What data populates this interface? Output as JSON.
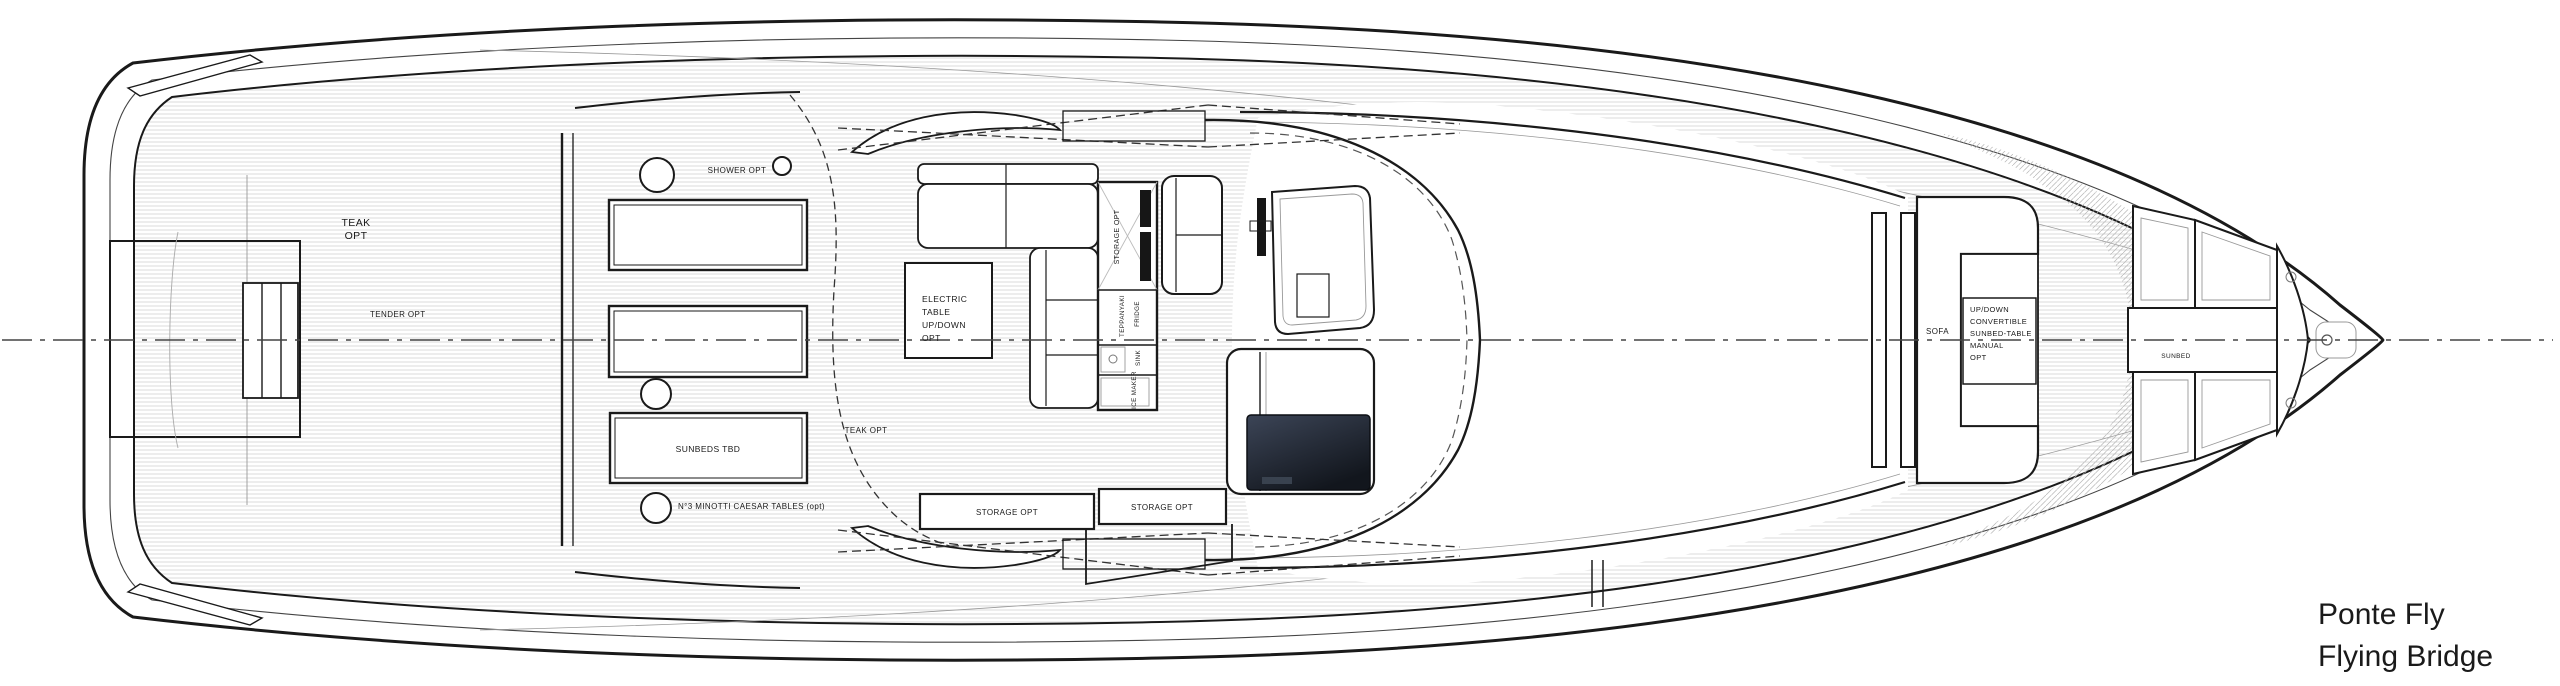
{
  "drawing": {
    "title_line1": "Ponte Fly",
    "title_line2": "Flying Bridge"
  },
  "labels": {
    "teak_aft": [
      "TEAK",
      "OPT"
    ],
    "tender": "TENDER OPT",
    "shower": "SHOWER OPT",
    "sunbeds_tbd": "SUNBEDS TBD",
    "minotti_tables": "N°3 MINOTTI CAESAR TABLES (opt)",
    "teak_mid": "TEAK OPT",
    "electric_table": [
      "ELECTRIC",
      "TABLE",
      "UP/DOWN",
      "OPT"
    ],
    "bar_storage": "STORAGE OPT",
    "teppanyaki": "TEPPANYAKI",
    "fridge": "FRIDGE",
    "sink": "SINK",
    "ice_maker": "ICE MAKER",
    "storage_left": "STORAGE OPT",
    "storage_right": "STORAGE OPT",
    "sofa": "SOFA",
    "convertible_table": [
      "UP/DOWN",
      "CONVERTIBLE",
      "SUNBED-TABLE",
      "MANUAL",
      "OPT"
    ],
    "sunbed_bow": "SUNBED"
  },
  "colors": {
    "line": "#1a1a1a",
    "thin_line": "#8a8a8a",
    "teak_line": "#cccccc",
    "hatch_line": "#b5b5b5",
    "screen_top": "#3c4557",
    "screen_bottom": "#12161d",
    "background": "#ffffff"
  }
}
